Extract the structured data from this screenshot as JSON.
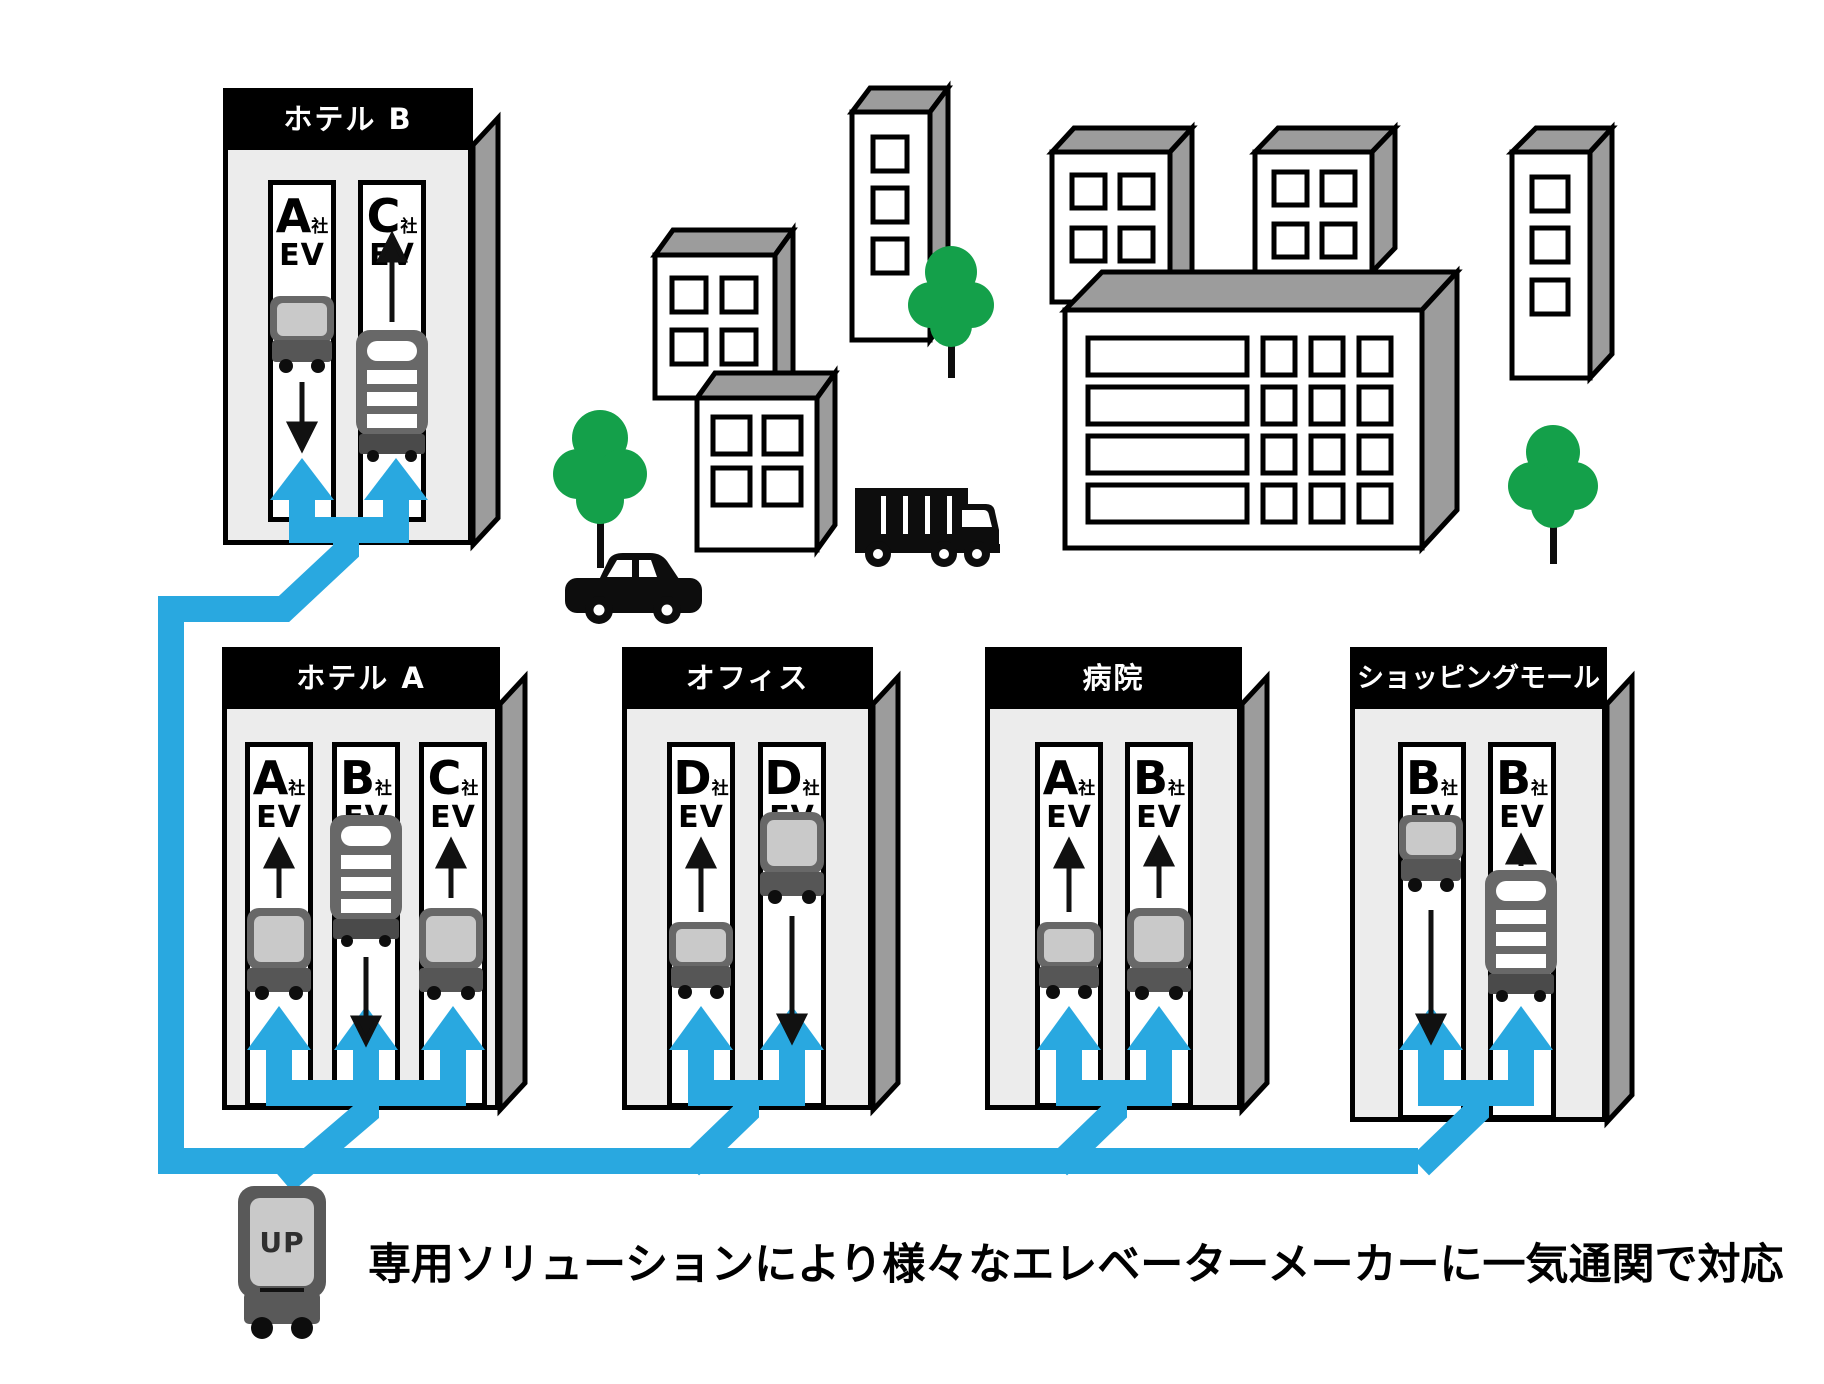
{
  "caption": "専用ソリューションにより様々なエレベーターメーカーに一気通関で対応",
  "robot": {
    "label": "UP"
  },
  "colors": {
    "line_blue": "#29A8E0",
    "tree_green": "#14A04A",
    "building_body_gray": "#ECECEC",
    "building_side_gray": "#9C9C9C",
    "header_black": "#000000",
    "robot_dark_gray": "#686868",
    "robot_panel_gray": "#C9C9C9",
    "vehicle_black": "#0D0D0D"
  },
  "buildings": [
    {
      "name": "ホテル B",
      "shafts": [
        {
          "company": "A",
          "suffix": "社",
          "ev": "EV",
          "robot": "cart-small",
          "robot_pos": "top",
          "arrow": "down"
        },
        {
          "company": "C",
          "suffix": "社",
          "ev": "EV",
          "robot": "shelf",
          "robot_pos": "bottom",
          "arrow": "up"
        }
      ]
    },
    {
      "name": "ホテル A",
      "shafts": [
        {
          "company": "A",
          "suffix": "社",
          "ev": "EV",
          "robot": "cart-tall",
          "robot_pos": "bottom",
          "arrow": "up"
        },
        {
          "company": "B",
          "suffix": "社",
          "ev": "EV",
          "robot": "shelf",
          "robot_pos": "top",
          "arrow": "down"
        },
        {
          "company": "C",
          "suffix": "社",
          "ev": "EV",
          "robot": "cart-tall",
          "robot_pos": "bottom",
          "arrow": "up"
        }
      ]
    },
    {
      "name": "オフィス",
      "shafts": [
        {
          "company": "D",
          "suffix": "社",
          "ev": "EV",
          "robot": "cart-small",
          "robot_pos": "bottom",
          "arrow": "up"
        },
        {
          "company": "D",
          "suffix": "社",
          "ev": "EV",
          "robot": "cart-tall",
          "robot_pos": "top",
          "arrow": "down"
        }
      ]
    },
    {
      "name": "病院",
      "shafts": [
        {
          "company": "A",
          "suffix": "社",
          "ev": "EV",
          "robot": "cart-small",
          "robot_pos": "bottom",
          "arrow": "up"
        },
        {
          "company": "B",
          "suffix": "社",
          "ev": "EV",
          "robot": "cart-tall",
          "robot_pos": "bottom",
          "arrow": "up"
        }
      ]
    },
    {
      "name": "ショッピングモール",
      "shafts": [
        {
          "company": "B",
          "suffix": "社",
          "ev": "EV",
          "robot": "cart-small",
          "robot_pos": "top",
          "arrow": "down"
        },
        {
          "company": "B",
          "suffix": "社",
          "ev": "EV",
          "robot": "shelf",
          "robot_pos": "bottom",
          "arrow": "up"
        }
      ]
    }
  ],
  "icons": {
    "cart-robot-icon": "delivery cart robot",
    "shelf-robot-icon": "shelf tower robot",
    "up-robot-icon": "UP service robot",
    "tree-icon": "street tree",
    "car-icon": "sedan car",
    "truck-icon": "box truck",
    "up-arrow-icon": "elevator moving up",
    "down-arrow-icon": "elevator moving down",
    "blue-network-icon": "robot-to-elevator connection lines"
  }
}
